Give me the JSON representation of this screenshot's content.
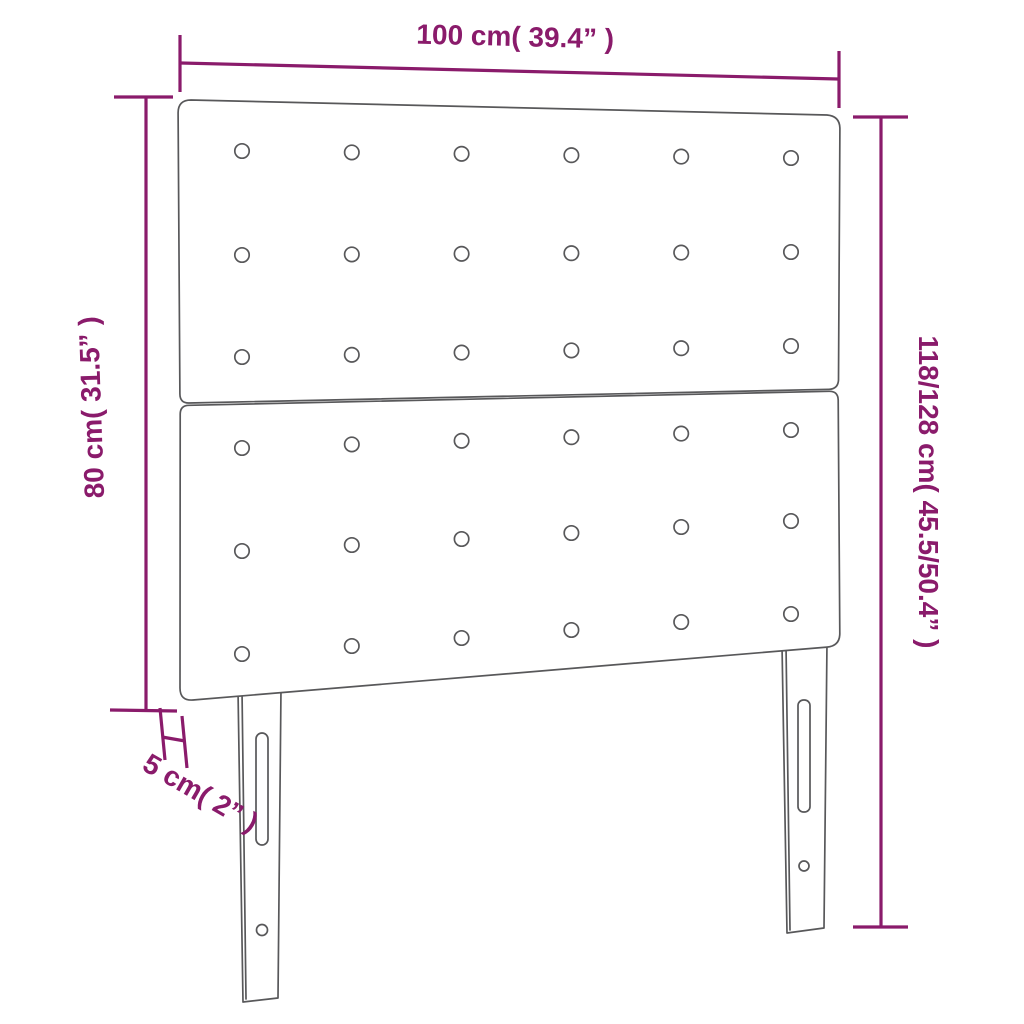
{
  "diagram": {
    "title": "headboard dimension diagram",
    "accent_color": "#8a1b6b",
    "line_color": "#58585a",
    "dimensions": {
      "width_label": "100 cm( 39.4” )",
      "height_left_label": "80 cm( 31.5” )",
      "height_right_label": "118/128 cm( 45.5/50.4” )",
      "thickness_label": "5 cm( 2” )"
    },
    "headboard": {
      "panels": 2,
      "button_rows_per_panel": 3,
      "button_cols": 6,
      "legs": 2
    }
  }
}
